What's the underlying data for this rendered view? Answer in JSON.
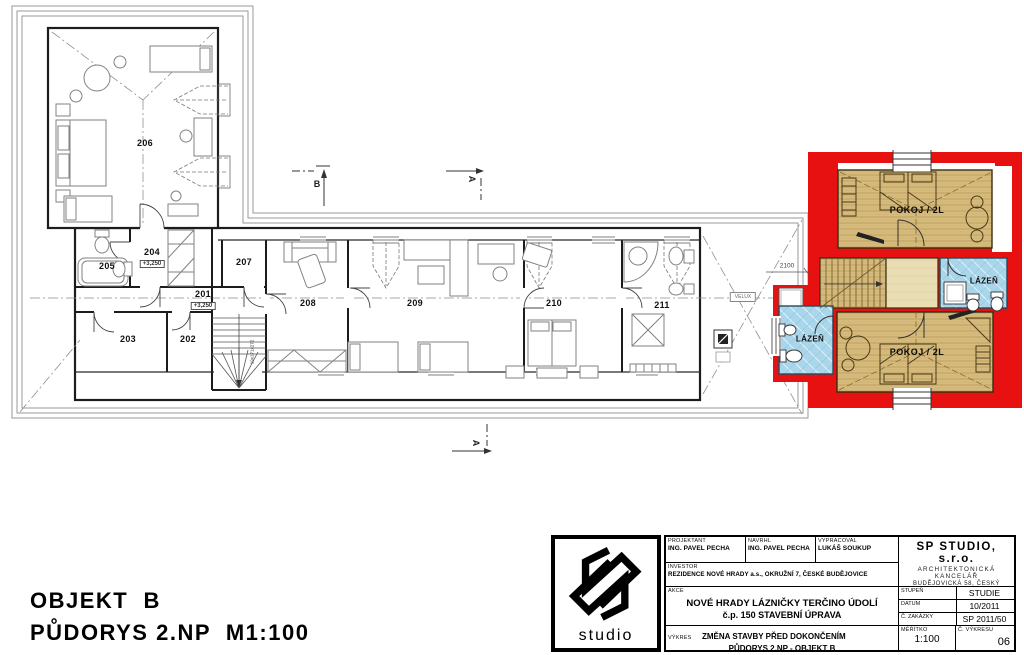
{
  "drawing_title": {
    "line1": "OBJEKT  B",
    "line2": "PŮDORYS 2.NP  M1:100"
  },
  "plan": {
    "rooms": {
      "r201": "201",
      "r202": "202",
      "r203": "203",
      "r204": "204",
      "r205": "205",
      "r206": "206",
      "r207": "207",
      "r208": "208",
      "r209": "209",
      "r210": "210",
      "r211": "211"
    },
    "levels": {
      "r201": "+3,250",
      "r204": "+3,250"
    },
    "annex": {
      "pokoj_top": "POKOJ / 2L",
      "pokoj_bottom": "POKOJ / 2L",
      "lazen_left": "LÁZEŇ",
      "lazen_right": "LÁZEŇ"
    },
    "annotations": {
      "velux": "VELUX",
      "dim_width": "2100",
      "stair_dim": "19x171x272"
    },
    "sections": {
      "b": "B",
      "a_top": "A",
      "a_bottom": "A"
    }
  },
  "title_block": {
    "logo_text": "studio",
    "cells": {
      "projektant_label": "PROJEKTANT",
      "projektant_value": "ING. PAVEL PECHA",
      "navrhl_label": "NAVRHL",
      "navrhl_value": "ING. PAVEL PECHA",
      "vypracoval_label": "VYPRACOVAL",
      "vypracoval_value": "LUKÁŠ SOUKUP",
      "investor_label": "INVESTOR",
      "investor_value": "REZIDENCE NOVÉ HRADY a.s., OKRUŽNÍ 7, ČESKÉ BUDĚJOVICE",
      "akce_label": "AKCE",
      "akce_line1": "NOVÉ HRADY LÁZNIČKY TERČINO ÚDOLÍ",
      "akce_line2": "č.p. 150 STAVEBNÍ ÚPRAVA",
      "vykres_label": "VÝKRES",
      "vykres_line1": "ZMĚNA STAVBY PŘED DOKONČENÍM",
      "vykres_line2": "PŮDORYS 2.NP - OBJEKT B",
      "stupen_label": "STUPEŇ",
      "stupen_value": "STUDIE",
      "datum_label": "DATUM",
      "datum_value": "10/2011",
      "zakazka_label": "Č. ZAKÁZKY",
      "zakazka_value": "SP  2011/50",
      "meritko_label": "MĚŘÍTKO",
      "meritko_value": "1:100",
      "cislo_vykresu_label": "Č. VÝKRESU",
      "cislo_vykresu_value": "06"
    },
    "company": {
      "name": "SP  STUDIO, s.r.o.",
      "line1": "ARCHITEKTONICKÁ  KANCELÁŘ",
      "line2": "BUDĚJOVICKÁ  58, ČESKÝ KRUMLOV",
      "line3": "TEL: 380 711 315, E-MAIL: info@spstudio.cz"
    }
  },
  "colors": {
    "highlight_red": "#e81111",
    "floor_tan": "#d7bb7e",
    "floor_tan_light": "#e9ddb4",
    "tile_blue": "#a9d6ea",
    "line_dark": "#1c1c1c",
    "roof_gray": "#999999"
  }
}
